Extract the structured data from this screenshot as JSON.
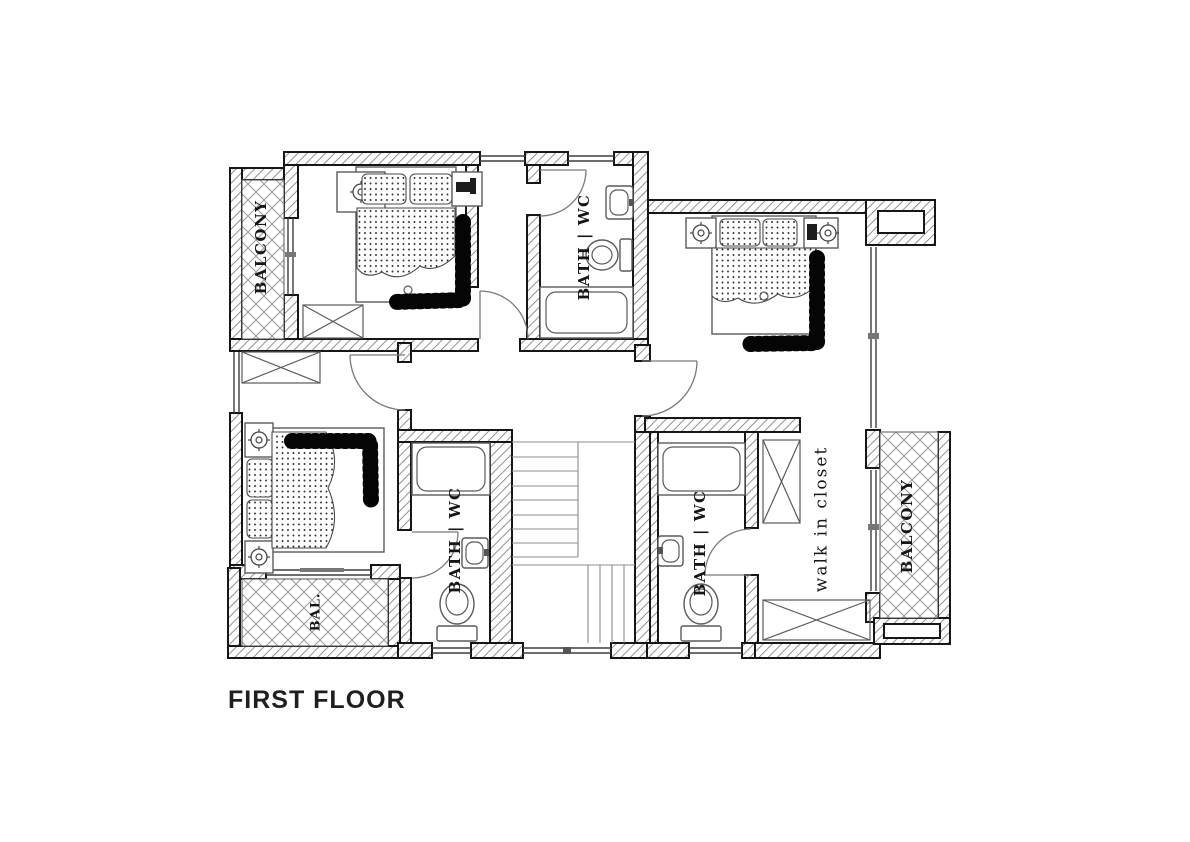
{
  "title": "FIRST FLOOR",
  "labels": {
    "balcony_top_left": "BALCONY",
    "balcony_bottom_left": "BAL.",
    "balcony_right": "BALCONY",
    "bath_top": "BATH | WC",
    "bath_left": "BATH | WC",
    "bath_right": "BATH | WC",
    "walk_in_closet": "walk in closet"
  },
  "colors": {
    "paper": "#ffffff",
    "ink": "#161616",
    "wall_hatch": "#8a8a8a",
    "lattice": "#9a9a9a",
    "furniture_line": "#5a5a5a",
    "title_color": "#1f1f1f"
  }
}
